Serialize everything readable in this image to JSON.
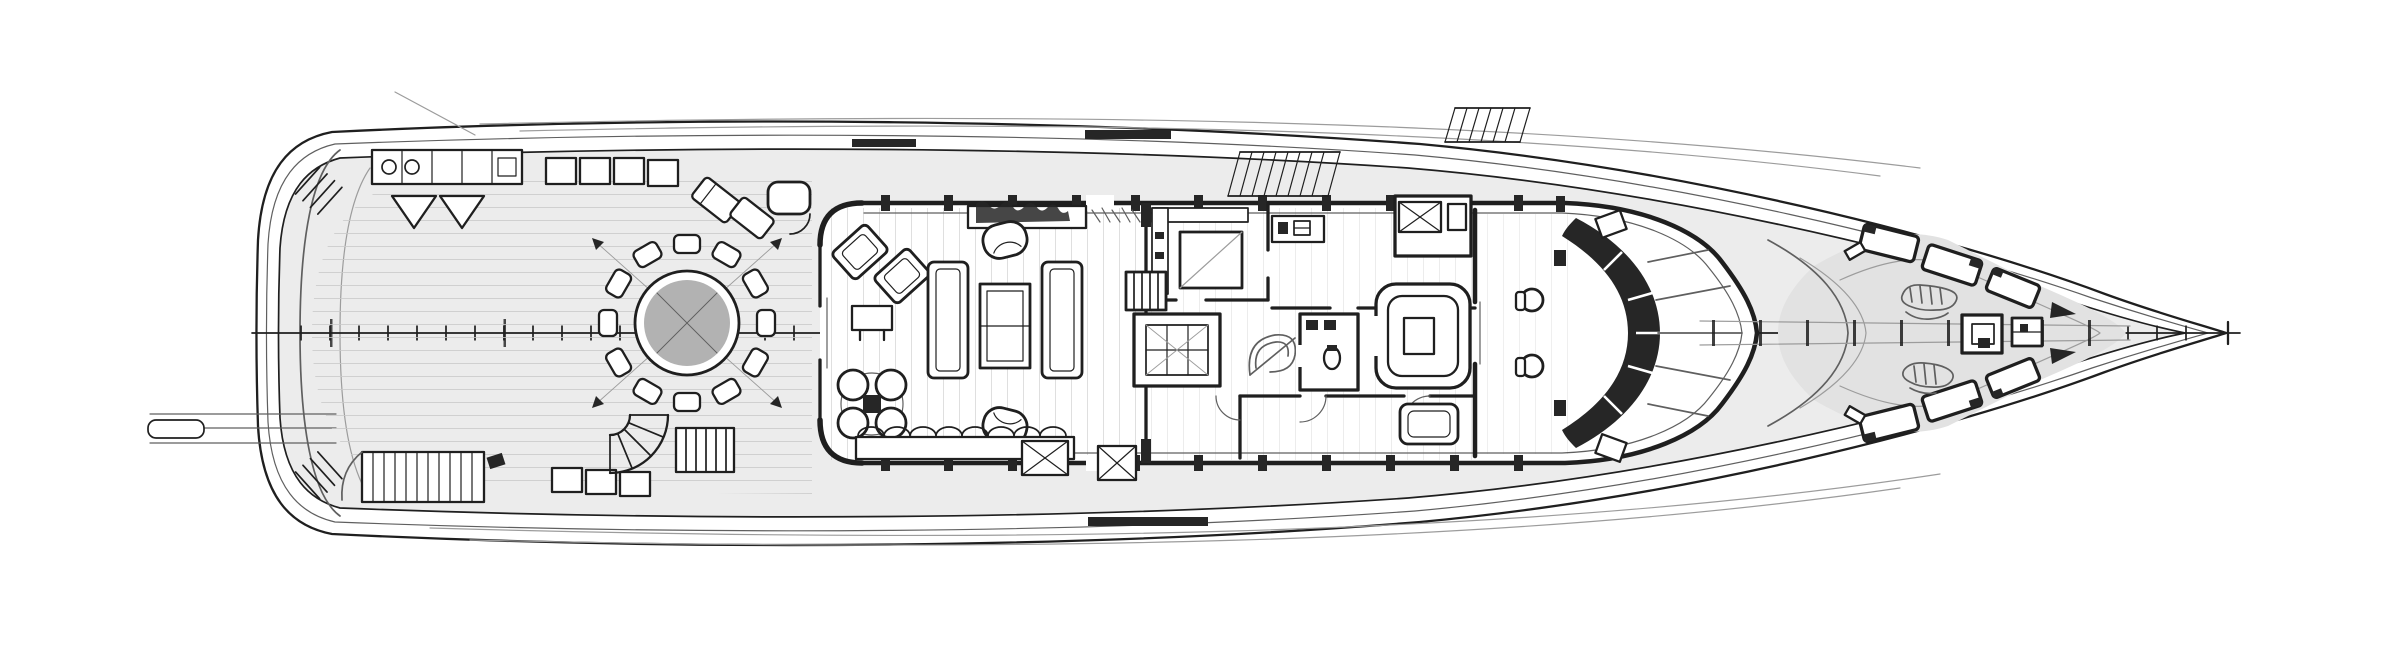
{
  "document": {
    "title": "Superyacht main deck general arrangement plan — top-down naval architecture line drawing, bow to the right, stern to the left",
    "drawing_style": "monochrome ink floor plan on white background, no visible text labels"
  },
  "canvas": {
    "width": 2400,
    "height": 672
  },
  "palette": {
    "paper": "#ffffff",
    "ink": "#1f1f1f",
    "inkSoft": "#5f5f5f",
    "inkFaint": "#9c9c9c",
    "deckLight": "#ececec",
    "deckMid": "#e2e2e2",
    "plankLine": "#c9c9c9",
    "fillDark": "#262626",
    "tableGray": "#b2b2b2",
    "glassGray": "#f4f4f4"
  },
  "plan": {
    "orientation": {
      "bow": "right",
      "stern": "left"
    },
    "centerline": {
      "extent_px": [
        252,
        2240
      ],
      "station_tick_spacing_px": 29
    },
    "areas": [
      {
        "id": "swim-platform",
        "label": "Transom and swim platform with twin boarding steps and passerelle"
      },
      {
        "id": "aft-deck",
        "label": "Aft main deck with round dining table for twelve, sideboard, loungers and stairs"
      },
      {
        "id": "main-salon",
        "label": "Main salon with facing sofas, coffee table, armchairs, games table and sideboard"
      },
      {
        "id": "galley",
        "label": "Galley with island and counters"
      },
      {
        "id": "stair-lobby",
        "label": "Staircase, stairwell skylight and lobby"
      },
      {
        "id": "day-head",
        "label": "Day head with WC and twin basins"
      },
      {
        "id": "corridor",
        "label": "Central corridor with cabin doors"
      },
      {
        "id": "captain-office",
        "label": "Captain office cabin with dresser"
      },
      {
        "id": "pilothouse",
        "label": "Pilothouse with U-settee, twin helm chairs and curved console"
      },
      {
        "id": "foredeck",
        "label": "Foredeck with angled sun pads, anchor windlasses, deck hatches and mooring gear"
      }
    ],
    "furniture_counts": {
      "dining_chairs_round_table": 12,
      "salon_sofas": 2,
      "salon_armchairs": 4,
      "games_table_chairs": 4,
      "helm_chairs": 2,
      "foredeck_sun_pads": 6
    }
  }
}
